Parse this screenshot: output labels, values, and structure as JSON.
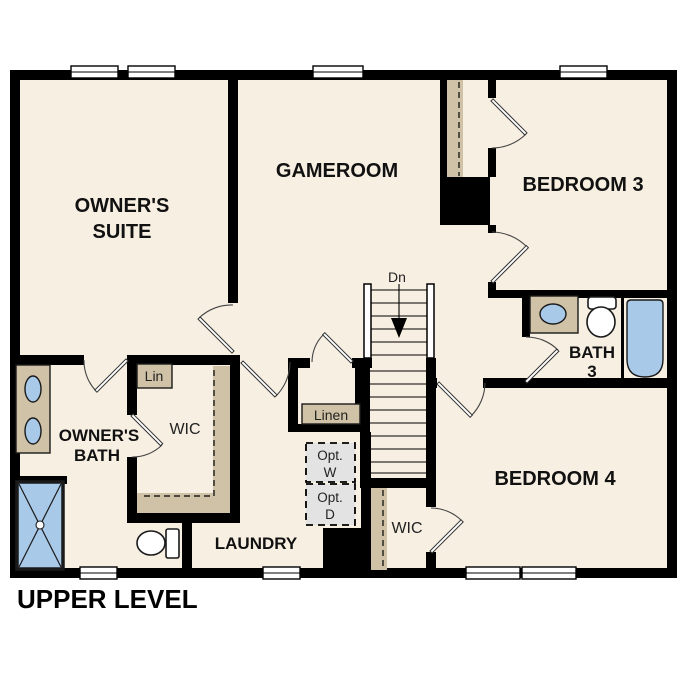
{
  "plan_title": "UPPER LEVEL",
  "colors": {
    "room_fill": "#f7efe2",
    "wall": "#000000",
    "casework": "#cfc2a6",
    "fixture_blue": "#a9c9e9",
    "optional_fill": "#e3e3e3"
  },
  "rooms": {
    "owners_suite": {
      "line1": "OWNER'S",
      "line2": "SUITE"
    },
    "gameroom": {
      "label": "GAMEROOM"
    },
    "bedroom3": {
      "label": "BEDROOM 3"
    },
    "bedroom4": {
      "label": "BEDROOM 4"
    },
    "bath3": {
      "line1": "BATH",
      "line2": "3"
    },
    "owners_bath": {
      "line1": "OWNER'S",
      "line2": "BATH"
    },
    "laundry": {
      "label": "LAUNDRY"
    },
    "owners_wic": {
      "label": "WIC"
    },
    "bedroom4_wic": {
      "label": "WIC"
    },
    "lin_closet": {
      "label": "Lin"
    },
    "linen_closet": {
      "label": "Linen"
    },
    "optional_washer": {
      "line1": "Opt.",
      "line2": "W"
    },
    "optional_dryer": {
      "line1": "Opt.",
      "line2": "D"
    },
    "stairs": {
      "direction_label": "Dn"
    }
  },
  "fixtures": {
    "owners_bath": [
      "double-vanity-sinks",
      "shower",
      "toilet"
    ],
    "bath3": [
      "vanity-sink",
      "toilet",
      "bathtub"
    ]
  }
}
